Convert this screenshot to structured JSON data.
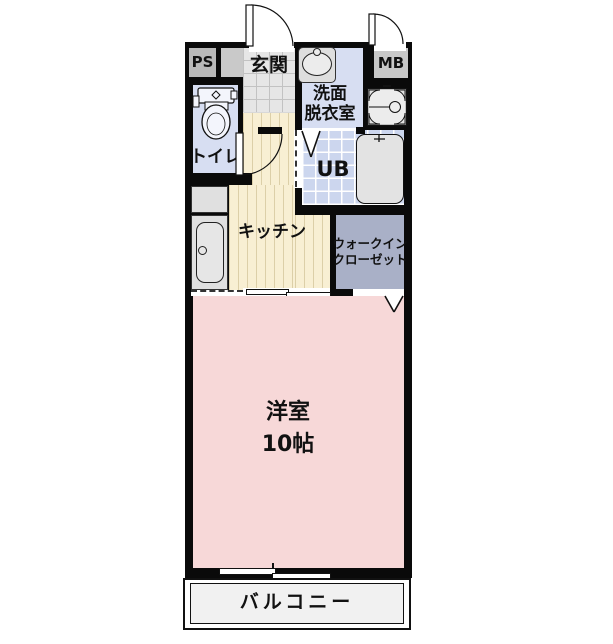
{
  "title": "単身向け1Kマンション間取り図",
  "rooms": {
    "ps": {
      "label": "PS"
    },
    "entrance": {
      "label": "玄関"
    },
    "mb": {
      "label": "MB"
    },
    "washroom": {
      "lines": [
        "洗面",
        "脱衣室"
      ]
    },
    "toilet": {
      "label": "トイレ"
    },
    "bath": {
      "label": "UB"
    },
    "kitchen": {
      "label": "キッチン"
    },
    "closet": {
      "lines": [
        "ウォークイン",
        "クローゼット"
      ]
    },
    "western": {
      "label": "洋室",
      "size": "10帖"
    },
    "balcony": {
      "label": "バルコニー"
    }
  },
  "icons": {
    "entrance-door": "quarter-arc door swing",
    "mb-door": "quarter-arc door swing",
    "hallway-door": "quarter-arc door swing",
    "ub-door": "v door mark",
    "closet-door": "v door mark",
    "toilet": "toilet fixture shape",
    "washbasin": "oval basin in counter",
    "washer-pan": "washing machine pan with drain",
    "bathtub": "rounded tub with faucet",
    "kitchen-sink": "counter with sink and burner box",
    "sliding-window": "offset double pane symbol",
    "sliding-door": "offset double pane symbol"
  },
  "colors": {
    "wall": "#0a0a0a",
    "toilet_washroom": "#d7def2",
    "ub_tile": "#ccd6ee",
    "entrance_tile": "#e6e6e6",
    "kitchen_floor": "#f8efd3",
    "kitchen_stripe": "#dccfa8",
    "western_room": "#f7d8d8",
    "closet": "#a9b0c7",
    "meter_box": "#b9b9b9",
    "balcony": "#f1f1f1",
    "fixture": "#e0e0e0"
  }
}
